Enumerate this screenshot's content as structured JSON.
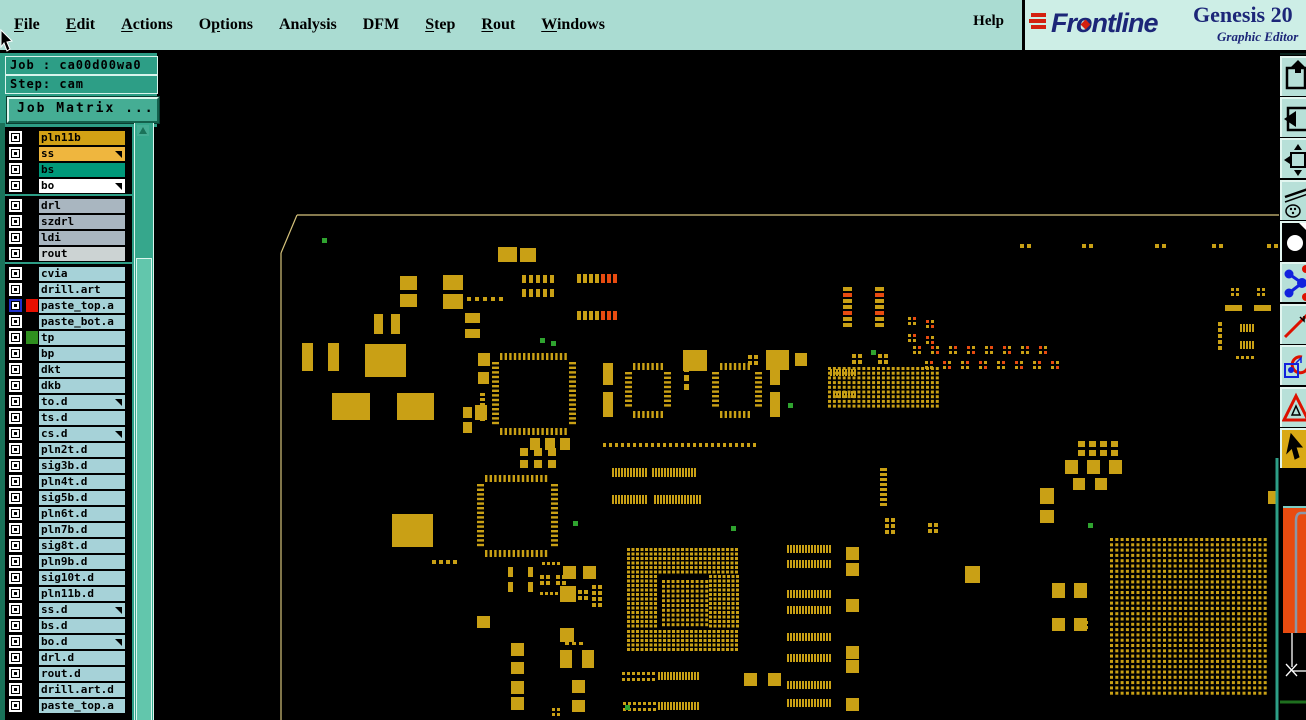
{
  "window": {
    "brand": "Frontline",
    "product": "Genesis 20",
    "subtitle": "Graphic Editor",
    "help_label": "Help"
  },
  "menu": {
    "items": [
      {
        "label": "File",
        "u": 0
      },
      {
        "label": "Edit",
        "u": 0
      },
      {
        "label": "Actions",
        "u": 0
      },
      {
        "label": "Options",
        "u": 1
      },
      {
        "label": "Analysis",
        "u": -1
      },
      {
        "label": "DFM",
        "u": -1
      },
      {
        "label": "Step",
        "u": 0
      },
      {
        "label": "Rout",
        "u": 0
      },
      {
        "label": "Windows",
        "u": 0
      }
    ]
  },
  "sidebar": {
    "job_label": "Job : ca00d00wa0",
    "step_label": "Step: cam",
    "matrix_button": "Job Matrix ...",
    "separators_after": [
      3,
      7
    ],
    "layers": [
      {
        "n": "pln11b",
        "c": "gold"
      },
      {
        "n": "ss",
        "c": "amber",
        "a": 1
      },
      {
        "n": "bs",
        "c": "tealgrn"
      },
      {
        "n": "bo",
        "c": "white",
        "a": 1
      },
      {
        "n": "drl",
        "c": "bluegrey"
      },
      {
        "n": "szdrl",
        "c": "bluegrey"
      },
      {
        "n": "ldi",
        "c": "bluegrey"
      },
      {
        "n": "rout",
        "c": "lightgrey"
      },
      {
        "n": "cvia",
        "c": "cyan"
      },
      {
        "n": "drill.art",
        "c": "cyan"
      },
      {
        "n": "paste_top.a",
        "c": "cyan",
        "sw": "#e81000",
        "cb": "blue"
      },
      {
        "n": "paste_bot.a",
        "c": "cyan"
      },
      {
        "n": "tp",
        "c": "cyan",
        "sw": "#2f8f1f"
      },
      {
        "n": "bp",
        "c": "cyan"
      },
      {
        "n": "dkt",
        "c": "cyan"
      },
      {
        "n": "dkb",
        "c": "cyan"
      },
      {
        "n": "to.d",
        "c": "cyan",
        "a": 1
      },
      {
        "n": "ts.d",
        "c": "cyan"
      },
      {
        "n": "cs.d",
        "c": "cyan",
        "a": 1
      },
      {
        "n": "pln2t.d",
        "c": "cyan"
      },
      {
        "n": "sig3b.d",
        "c": "cyan"
      },
      {
        "n": "pln4t.d",
        "c": "cyan"
      },
      {
        "n": "sig5b.d",
        "c": "cyan"
      },
      {
        "n": "pln6t.d",
        "c": "cyan"
      },
      {
        "n": "pln7b.d",
        "c": "cyan"
      },
      {
        "n": "sig8t.d",
        "c": "cyan"
      },
      {
        "n": "pln9b.d",
        "c": "cyan"
      },
      {
        "n": "sig10t.d",
        "c": "cyan"
      },
      {
        "n": "pln11b.d",
        "c": "cyan"
      },
      {
        "n": "ss.d",
        "c": "cyan",
        "a": 1
      },
      {
        "n": "bs.d",
        "c": "cyan"
      },
      {
        "n": "bo.d",
        "c": "cyan",
        "a": 1
      },
      {
        "n": "drl.d",
        "c": "cyan"
      },
      {
        "n": "rout.d",
        "c": "cyan"
      },
      {
        "n": "drill.art.d",
        "c": "cyan"
      },
      {
        "n": "paste_top.a",
        "c": "cyan"
      }
    ],
    "row_colors": {
      "gold": "#d2a115",
      "amber": "#efb63e",
      "tealgrn": "#00997a",
      "white": "#ffffff",
      "bluegrey": "#a9b6c0",
      "lightgrey": "#ccd3d3",
      "cyan": "#a6d2d8"
    }
  },
  "toolbar": {
    "tools": [
      "paste-up",
      "paste-left",
      "fit-window",
      "draw-tools",
      "pad-display",
      "netlist",
      "measure",
      "symbol-origin",
      "drc-marker",
      "pointer-select"
    ],
    "active": "pointer-select"
  },
  "canvas": {
    "colors": {
      "g": "#c9a015",
      "r": "#e84b10",
      "n": "#2fa32f",
      "t": "#d6c37c"
    },
    "outline": [
      [
        297,
        215,
        1280,
        215
      ],
      [
        297,
        215,
        281,
        253
      ],
      [
        281,
        253,
        281,
        720
      ]
    ],
    "rects": [
      [
        498,
        247,
        19,
        15
      ],
      [
        520,
        248,
        16,
        14
      ],
      [
        400,
        276,
        17,
        14
      ],
      [
        400,
        294,
        17,
        13
      ],
      [
        443,
        275,
        20,
        15
      ],
      [
        443,
        294,
        20,
        15
      ],
      [
        374,
        314,
        9,
        20
      ],
      [
        391,
        314,
        9,
        20
      ],
      [
        302,
        343,
        11,
        28
      ],
      [
        328,
        343,
        11,
        28
      ],
      [
        365,
        344,
        41,
        33
      ],
      [
        332,
        393,
        38,
        27
      ],
      [
        397,
        393,
        37,
        27
      ],
      [
        392,
        514,
        41,
        33
      ],
      [
        465,
        313,
        15,
        10
      ],
      [
        465,
        329,
        15,
        9
      ],
      [
        478,
        353,
        12,
        13
      ],
      [
        478,
        372,
        11,
        12
      ],
      [
        463,
        407,
        9,
        11
      ],
      [
        463,
        422,
        9,
        11
      ],
      [
        475,
        405,
        12,
        15
      ],
      [
        683,
        350,
        24,
        21
      ],
      [
        766,
        350,
        23,
        20
      ],
      [
        795,
        353,
        12,
        13
      ],
      [
        603,
        363,
        10,
        22
      ],
      [
        603,
        392,
        10,
        25
      ],
      [
        770,
        363,
        10,
        22
      ],
      [
        770,
        392,
        10,
        25
      ],
      [
        744,
        673,
        13,
        13
      ],
      [
        768,
        673,
        13,
        13
      ],
      [
        477,
        616,
        13,
        12
      ],
      [
        572,
        680,
        13,
        13
      ],
      [
        572,
        700,
        13,
        12
      ],
      [
        508,
        567,
        5,
        10
      ],
      [
        508,
        582,
        5,
        10
      ],
      [
        528,
        567,
        5,
        10
      ],
      [
        528,
        582,
        5,
        10
      ],
      [
        846,
        547,
        13,
        13
      ],
      [
        846,
        563,
        13,
        13
      ],
      [
        846,
        599,
        13,
        13
      ],
      [
        846,
        646,
        13,
        13
      ],
      [
        846,
        660,
        13,
        13
      ],
      [
        846,
        698,
        13,
        13
      ],
      [
        965,
        566,
        15,
        17
      ],
      [
        511,
        643,
        13,
        13
      ],
      [
        511,
        662,
        13,
        12
      ],
      [
        511,
        681,
        13,
        13
      ],
      [
        511,
        697,
        13,
        13
      ],
      [
        563,
        566,
        13,
        13
      ],
      [
        583,
        566,
        13,
        13
      ],
      [
        560,
        586,
        16,
        16
      ],
      [
        560,
        628,
        14,
        14
      ],
      [
        560,
        650,
        12,
        18
      ],
      [
        582,
        650,
        12,
        18
      ],
      [
        1065,
        460,
        13,
        14
      ],
      [
        1087,
        460,
        13,
        14
      ],
      [
        1109,
        460,
        13,
        14
      ],
      [
        1073,
        478,
        12,
        12
      ],
      [
        1095,
        478,
        12,
        12
      ],
      [
        1040,
        488,
        14,
        16
      ],
      [
        1040,
        510,
        14,
        13
      ],
      [
        1052,
        583,
        13,
        15
      ],
      [
        1074,
        583,
        13,
        15
      ],
      [
        1052,
        618,
        13,
        13
      ],
      [
        1074,
        618,
        13,
        13
      ],
      [
        1225,
        305,
        17,
        6
      ],
      [
        1254,
        305,
        17,
        6
      ],
      [
        1268,
        491,
        8,
        13
      ]
    ],
    "red_rects": [
      [
        1283,
        506,
        23,
        127
      ]
    ],
    "rows": [
      [
        612,
        468,
        12,
        2,
        9,
        1
      ],
      [
        652,
        468,
        15,
        2,
        9,
        1
      ],
      [
        612,
        495,
        12,
        2,
        9,
        1
      ],
      [
        654,
        495,
        16,
        2,
        9,
        1
      ],
      [
        658,
        672,
        14,
        2,
        8,
        1
      ],
      [
        658,
        702,
        14,
        2,
        8,
        1
      ],
      [
        603,
        443,
        26,
        3,
        4,
        3
      ],
      [
        830,
        369,
        9,
        2,
        7,
        1
      ],
      [
        833,
        391,
        8,
        2,
        7,
        1
      ],
      [
        522,
        275,
        5,
        4,
        8,
        3
      ],
      [
        522,
        289,
        5,
        4,
        8,
        3
      ],
      [
        787,
        545,
        15,
        2,
        8,
        1
      ],
      [
        787,
        560,
        15,
        2,
        8,
        1
      ],
      [
        787,
        590,
        15,
        2,
        8,
        1
      ],
      [
        787,
        606,
        15,
        2,
        8,
        1
      ],
      [
        787,
        633,
        15,
        2,
        8,
        1
      ],
      [
        787,
        654,
        15,
        2,
        8,
        1
      ],
      [
        787,
        681,
        15,
        2,
        8,
        1
      ],
      [
        787,
        699,
        15,
        2,
        8,
        1
      ],
      [
        1240,
        324,
        5,
        2,
        8,
        1
      ],
      [
        1240,
        341,
        5,
        2,
        8,
        1
      ],
      [
        1236,
        356,
        4,
        3,
        3,
        2
      ],
      [
        432,
        560,
        4,
        4,
        4,
        3
      ],
      [
        530,
        438,
        3,
        10,
        12,
        5
      ],
      [
        565,
        642,
        3,
        4,
        3,
        3
      ],
      [
        1020,
        244,
        2,
        4,
        4,
        3
      ],
      [
        1082,
        244,
        2,
        4,
        4,
        3
      ],
      [
        1155,
        244,
        2,
        4,
        4,
        3
      ],
      [
        1212,
        244,
        2,
        4,
        4,
        3
      ],
      [
        1267,
        244,
        2,
        4,
        4,
        3
      ],
      [
        542,
        562,
        4,
        3,
        3,
        2
      ],
      [
        540,
        592,
        5,
        3,
        3,
        2
      ],
      [
        467,
        297,
        5,
        4,
        4,
        4
      ]
    ],
    "cols": [
      [
        684,
        366,
        3,
        5,
        6,
        3
      ],
      [
        880,
        468,
        8,
        7,
        3,
        2
      ],
      [
        1218,
        322,
        3,
        4,
        4,
        2
      ],
      [
        1218,
        340,
        2,
        4,
        4,
        2
      ],
      [
        480,
        393,
        6,
        5,
        3,
        2
      ]
    ],
    "grids": [
      [
        627,
        548,
        25,
        6,
        3,
        3,
        4.5,
        4.5
      ],
      [
        627,
        630,
        25,
        5,
        3,
        3,
        4.5,
        4.5
      ],
      [
        627,
        575,
        7,
        12,
        3,
        3,
        4.5,
        4.5
      ],
      [
        709,
        575,
        7,
        12,
        3,
        3,
        4.5,
        4.5
      ],
      [
        662,
        580,
        10,
        10,
        3,
        3,
        4.8,
        4.8
      ],
      [
        1110,
        538,
        30,
        30,
        3,
        3,
        5.3,
        5.3
      ],
      [
        828,
        367,
        23,
        9,
        3,
        3,
        4.9,
        4.7
      ],
      [
        885,
        518,
        2,
        3,
        4,
        4,
        6,
        6
      ],
      [
        928,
        523,
        2,
        2,
        4,
        4,
        6,
        6
      ],
      [
        1078,
        441,
        4,
        2,
        7,
        6,
        11,
        9
      ],
      [
        622,
        672,
        7,
        2,
        3,
        3,
        5,
        6
      ],
      [
        623,
        702,
        7,
        2,
        3,
        3,
        5,
        6
      ],
      [
        520,
        448,
        3,
        2,
        8,
        8,
        14,
        12
      ],
      [
        592,
        585,
        2,
        4,
        4,
        4,
        6,
        6
      ],
      [
        1080,
        621,
        2,
        2,
        3,
        3,
        5,
        5
      ],
      [
        552,
        708,
        2,
        2,
        3,
        3,
        5,
        5
      ],
      [
        540,
        575,
        2,
        2,
        4,
        4,
        6,
        6
      ],
      [
        556,
        575,
        2,
        2,
        4,
        4,
        6,
        6
      ],
      [
        578,
        590,
        2,
        2,
        4,
        4,
        6,
        6
      ],
      [
        748,
        355,
        2,
        2,
        4,
        4,
        6,
        6
      ],
      [
        852,
        354,
        2,
        2,
        4,
        4,
        6,
        6
      ],
      [
        878,
        354,
        2,
        2,
        4,
        4,
        6,
        6
      ],
      [
        1231,
        288,
        2,
        2,
        3,
        3,
        5,
        5
      ],
      [
        1257,
        288,
        2,
        2,
        3,
        3,
        5,
        5
      ]
    ],
    "qfps": [
      [
        492,
        353,
        84,
        82
      ],
      [
        477,
        475,
        81,
        82
      ],
      [
        625,
        363,
        46,
        55
      ],
      [
        712,
        363,
        50,
        55
      ]
    ],
    "mixrows": [
      [
        577,
        274,
        4,
        9,
        2,
        [
          "g",
          "g",
          "g",
          "g",
          "r",
          "r",
          "r"
        ]
      ],
      [
        577,
        311,
        4,
        9,
        2,
        [
          "g",
          "g",
          "g",
          "g",
          "r",
          "r",
          "r"
        ]
      ]
    ],
    "mixcols": [
      [
        843,
        287,
        9,
        4,
        2,
        [
          "g",
          "r",
          "g",
          "g",
          "r",
          "g",
          "g"
        ]
      ],
      [
        875,
        287,
        9,
        4,
        2,
        [
          "g",
          "r",
          "g",
          "g",
          "r",
          "g",
          "g"
        ]
      ]
    ],
    "clusters": [
      [
        913,
        346
      ],
      [
        931,
        346
      ],
      [
        949,
        346
      ],
      [
        967,
        346
      ],
      [
        985,
        346
      ],
      [
        1003,
        346
      ],
      [
        1021,
        346
      ],
      [
        1039,
        346
      ],
      [
        925,
        361
      ],
      [
        943,
        361
      ],
      [
        961,
        361
      ],
      [
        979,
        361
      ],
      [
        997,
        361
      ],
      [
        1015,
        361
      ],
      [
        1033,
        361
      ],
      [
        1051,
        361
      ],
      [
        908,
        317
      ],
      [
        926,
        320
      ],
      [
        908,
        334
      ],
      [
        926,
        336
      ]
    ],
    "greens": [
      [
        322,
        238
      ],
      [
        540,
        338
      ],
      [
        551,
        341
      ],
      [
        871,
        350
      ],
      [
        731,
        526
      ],
      [
        1088,
        523
      ],
      [
        573,
        521
      ],
      [
        625,
        705
      ],
      [
        788,
        403
      ]
    ],
    "overlay": {
      "cyan_line": [
        1283,
        507,
        1306,
        507
      ],
      "grey_path": "M1306,513 L1301,513 Q1296,513 1296,521 L1296,633",
      "white_lines": [
        [
          1292,
          633,
          1292,
          667
        ],
        [
          1292,
          671,
          1306,
          671
        ],
        [
          1286,
          664,
          1297,
          676
        ],
        [
          1297,
          664,
          1286,
          676
        ]
      ],
      "green_line": [
        1280,
        702,
        1306,
        702
      ],
      "teal_border": [
        1277,
        458,
        1277,
        720
      ]
    }
  }
}
